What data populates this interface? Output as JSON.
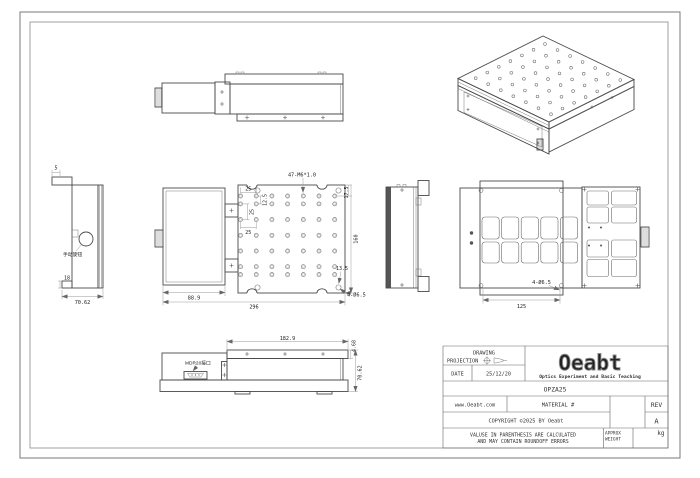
{
  "colors": {
    "line": "#4a4a4a",
    "dim_text": "#222222",
    "frame": "#7a7a7a",
    "logo_stroke": "#8a8a8a"
  },
  "title_block": {
    "drawing_label": "DRAWING",
    "projection_label": "PROJECTION",
    "date_label": "DATE",
    "date_value": "25/12/20",
    "logo_text": "Oeabt",
    "logo_tagline": "Optics Experiment and Basic Teaching",
    "part_number": "OPZA25",
    "website": "www.Oeabt.com",
    "material_label": "MATERIAL #",
    "rev_label": "REV",
    "rev_value": "A",
    "copyright_text": "COPYRIGHT ©2025 BY Oeabt",
    "note_line1": "VALUSE IN PARENTHESIS ARE CALCULATED",
    "note_line2": "AND MAY CONTAIN ROUNDOFF ERRORS",
    "weight_label_line1": "APPROX",
    "weight_label_line2": "WEIGHT",
    "weight_unit": "kg"
  },
  "views": {
    "left_end_view": {
      "dim_flange": "5",
      "dim_base": "18",
      "dim_width": "70.62",
      "knob_label": "手动旋钮"
    },
    "plan_view": {
      "thread_callout": "47-M6*1.0",
      "dim_pitch_h1": "25",
      "dim_pitch_v1": "12.5",
      "dim_pitch_v2": "25",
      "dim_pitch_h2": "25",
      "dim_edge_top": "17.5",
      "dim_height": "160",
      "dim_corner": "13.5",
      "hole_callout": "4-Ø6.5",
      "dim_carriage_width": "88.9",
      "dim_overall_length": "296"
    },
    "bottom_view": {
      "hole_callout": "4-Ø6.5",
      "dim_hole_spacing": "125"
    },
    "front_view": {
      "dim_body_length": "182.9",
      "dim_plate_thickness": "4.68",
      "dim_overall_height": "70.62",
      "connector_label": "MDR20接口"
    }
  }
}
